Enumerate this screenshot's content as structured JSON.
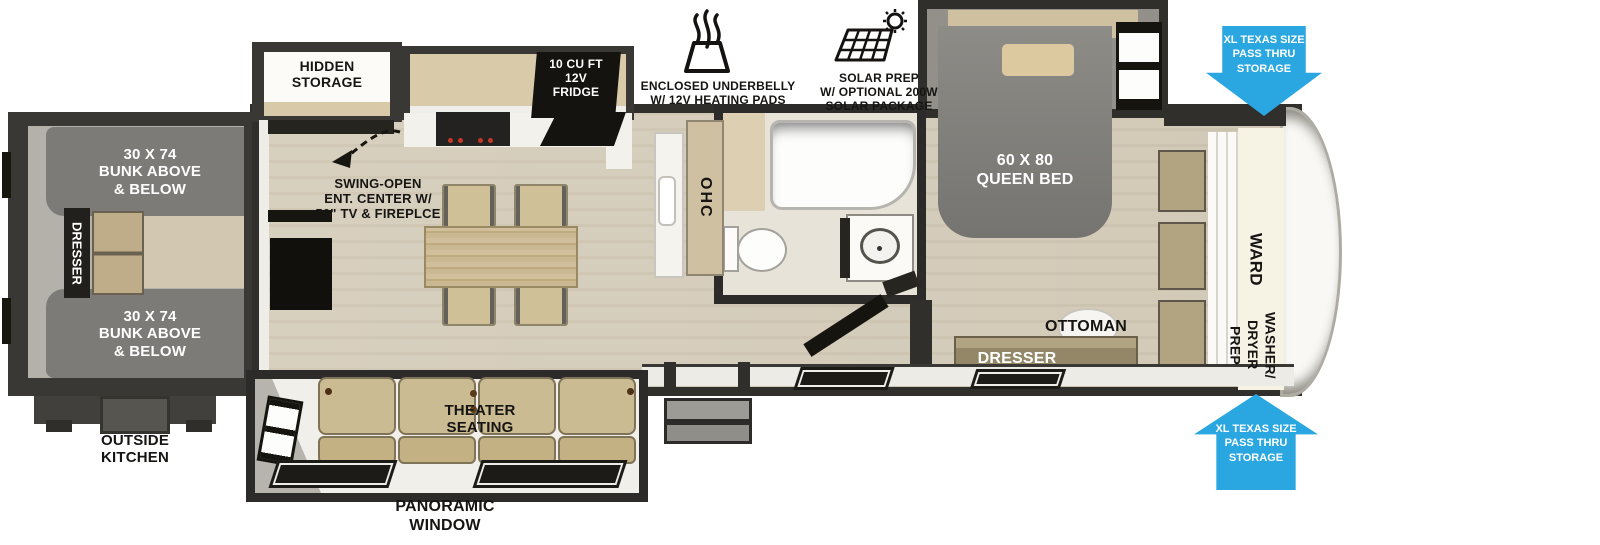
{
  "colors": {
    "wall": "#302f2c",
    "floor_wood": "#d5cdbc",
    "floor_gray": "#b4b1ab",
    "furniture_tan": "#cdbc92",
    "bunk_gray": "#7c7b77",
    "appliance_black": "#161511",
    "arrow_blue": "#2aa7e1",
    "label_dark": "#161513",
    "label_light": "#ffffff"
  },
  "icons": {
    "underbelly": "heat-waves-icon",
    "solar": "solar-panel-sun-icon",
    "swing": "dashed-swing-arrow-icon"
  },
  "labels": {
    "hidden_storage": "HIDDEN\nSTORAGE",
    "fridge": "10 CU FT\n12V\nFRIDGE",
    "underbelly": "ENCLOSED UNDERBELLY\nW/ 12V HEATING PADS",
    "solar": "SOLAR PREP\nW/ OPTIONAL 200W\nSOLAR PACKAGE",
    "pass_thru_top": "XL TEXAS SIZE\nPASS THRU\nSTORAGE",
    "pass_thru_bottom": "XL TEXAS SIZE\nPASS THRU\nSTORAGE",
    "bunk_top": "30 X 74\nBUNK ABOVE\n& BELOW",
    "bunk_bottom": "30 X 74\nBUNK ABOVE\n& BELOW",
    "bunk_dresser": "DRESSER",
    "outside_kitchen": "OUTSIDE\nKITCHEN",
    "ent_center": "SWING-OPEN\nENT. CENTER W/\n50\" TV & FIREPLCE",
    "ohc": "OHC",
    "queen_bed": "60 X 80\nQUEEN BED",
    "ward": "WARD",
    "washer_dryer": "WASHER/\nDRYER\nPREP",
    "ottoman": "OTTOMAN",
    "bedroom_dresser": "DRESSER",
    "theater_seating": "THEATER\nSEATING",
    "panoramic_window": "PANORAMIC\nWINDOW"
  }
}
